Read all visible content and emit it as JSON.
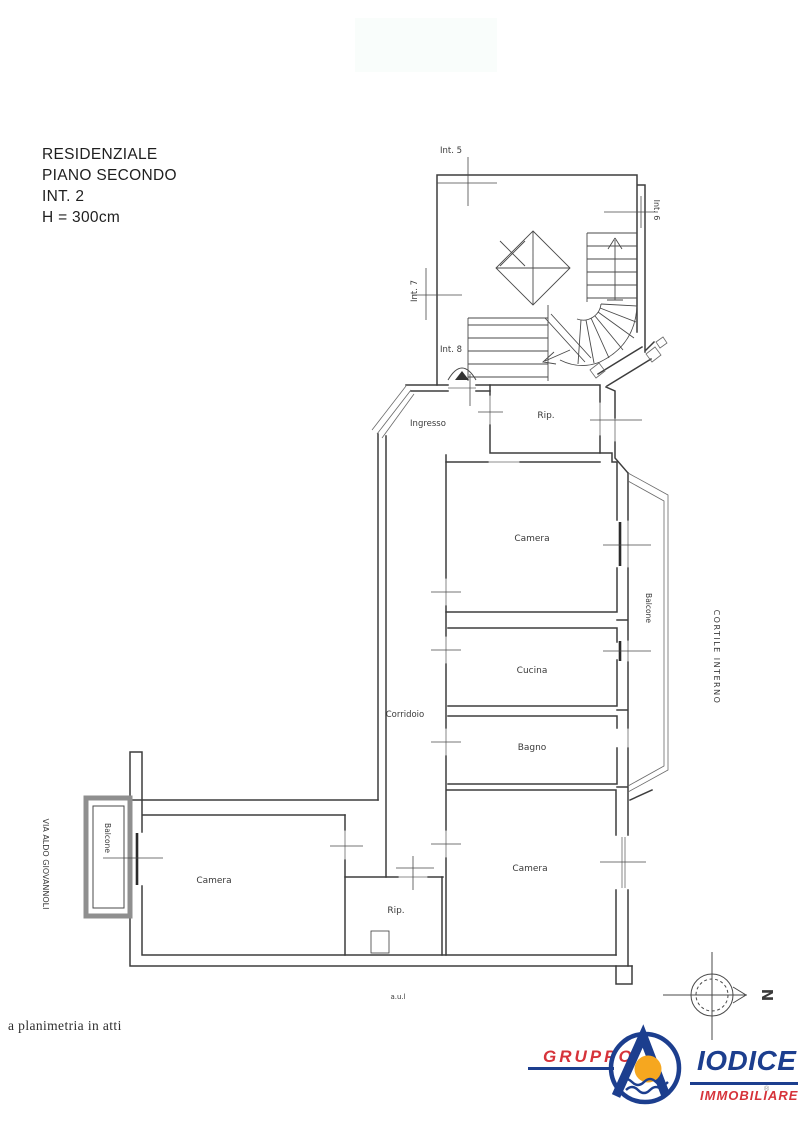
{
  "header": {
    "lines": [
      "RESIDENZIALE",
      "PIANO SECONDO",
      "INT. 2",
      "H = 300cm"
    ]
  },
  "plan": {
    "stair_labels": {
      "int5": "Int. 5",
      "int6": "Int. 6",
      "int7": "Int. 7",
      "int8": "Int. 8"
    },
    "rooms": {
      "ingresso": "Ingresso",
      "rip_top": "Rip.",
      "camera_top": "Camera",
      "cucina": "Cucina",
      "bagno": "Bagno",
      "corridoio": "Corridoio",
      "camera_right": "Camera",
      "rip_bottom": "Rip.",
      "camera_left": "Camera"
    },
    "balcone_right": "Balcone",
    "balcone_left": "Balcone",
    "cortile": "CORTILE INTERNO",
    "street": "VIA ALDO GIOVANNOLI",
    "compass": "N",
    "tiny_note": "a.u.l"
  },
  "footer": {
    "note": "a planimetria in atti"
  },
  "logo": {
    "gruppo": "GRUPPO",
    "name": "IODICE",
    "subtitle": "IMMOBILIARE",
    "reg": "®"
  },
  "colors": {
    "logo_blue": "#1c3e8e",
    "logo_red": "#d6333a",
    "logo_orange": "#f6a71f",
    "plan_line": "#3d3d3d"
  }
}
